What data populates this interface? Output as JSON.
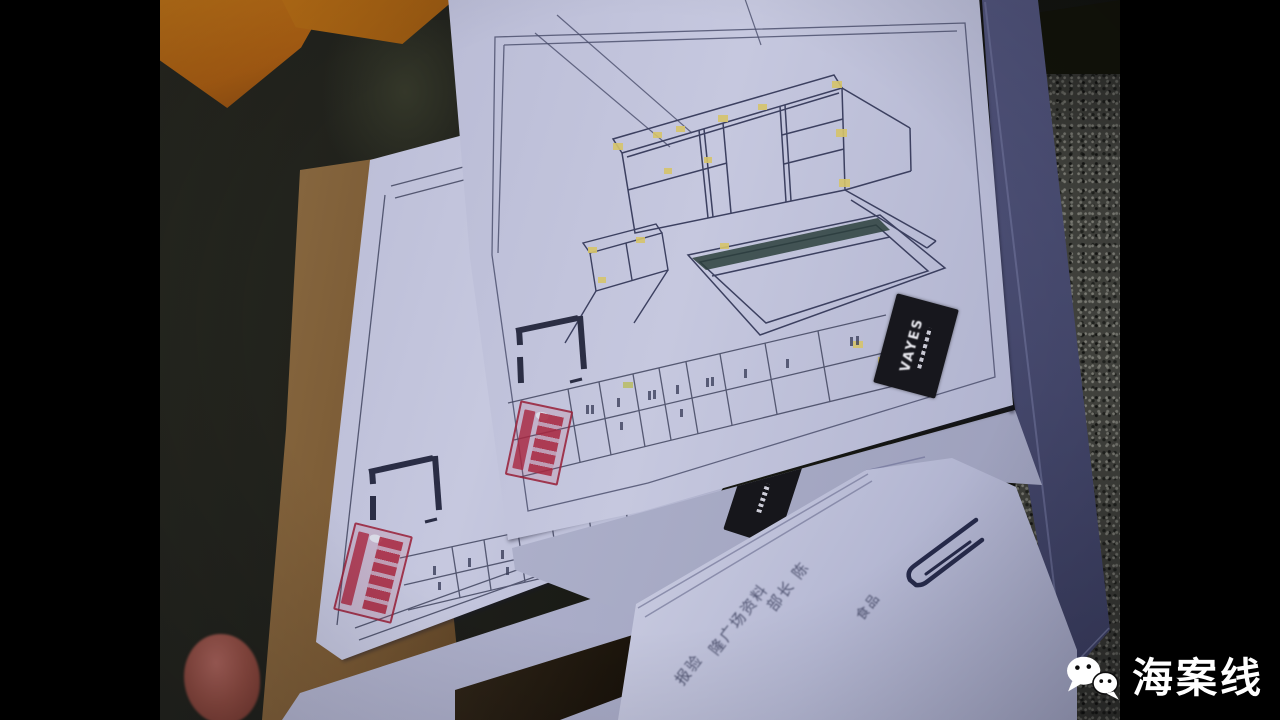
{
  "papers": {
    "vayes_label": "VAYES",
    "loose_document_lines": [
      "部长 陈",
      "食品",
      "隆广场资料",
      "报验"
    ]
  },
  "watermark": {
    "icon": "wechat-icon",
    "text": "海案线"
  },
  "colors": {
    "background": "#000000",
    "paper": "#bfc1da",
    "paper_shade": "#9da0bd",
    "navy_sheet": "#484c72",
    "cardboard": "#7c5c36",
    "granite": "#4b4c46",
    "accent_orange": "#c07417",
    "stamp_red": "#a83a52",
    "highlight_yellow": "#d6c46b",
    "line_ink": "#41455f",
    "watermark_text": "#ffffff"
  }
}
